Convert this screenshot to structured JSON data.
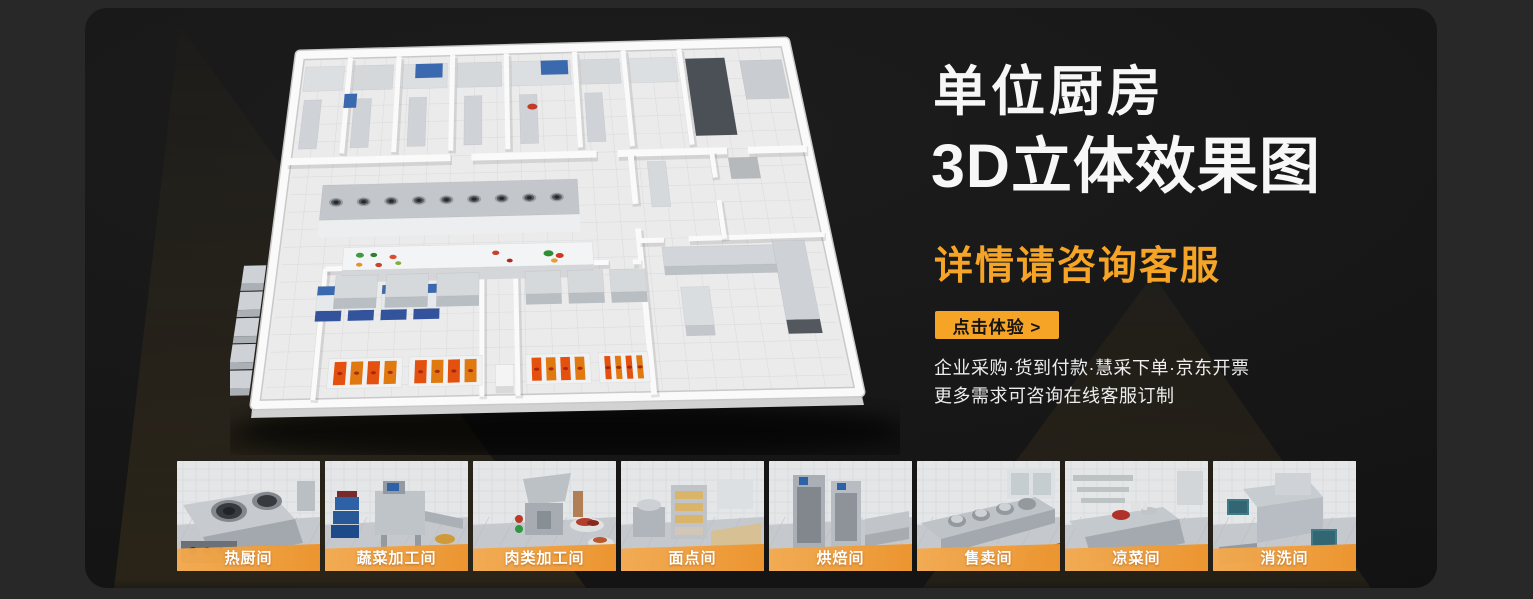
{
  "hero": {
    "title_line1": "单位厨房",
    "title_line2": "3D立体效果图",
    "subtitle": "详情请咨询客服",
    "cta_label": "点击体验 >",
    "note_line1": "企业采购·货到付款·慧采下单·京东开票",
    "note_line2": "更多需求可咨询在线客服订制"
  },
  "gallery": {
    "items": [
      {
        "label": "热厨间"
      },
      {
        "label": "蔬菜加工间"
      },
      {
        "label": "肉类加工间"
      },
      {
        "label": "面点间"
      },
      {
        "label": "烘焙间"
      },
      {
        "label": "售卖间"
      },
      {
        "label": "凉菜间"
      },
      {
        "label": "消洗间"
      }
    ]
  },
  "colors": {
    "accent_orange": "#F5A426",
    "band_orange": "#EC9530",
    "page_bg": "#282828",
    "card_bg": "#171717",
    "title_white": "#F7F7F7"
  }
}
